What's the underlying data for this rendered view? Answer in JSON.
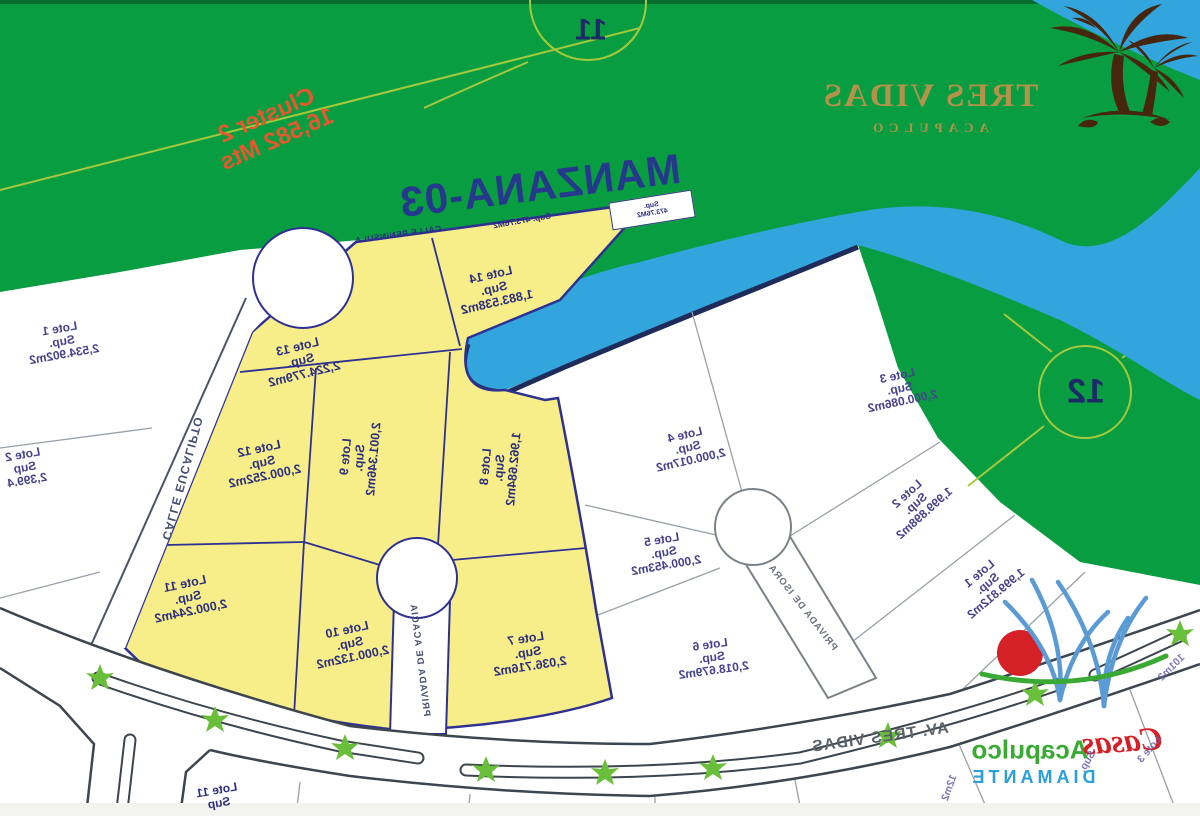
{
  "branding": {
    "resort_title": "TRES VIDAS",
    "resort_subtitle": "ACAPULCO",
    "footer_brand_script": "Casas",
    "footer_brand_name": "Acapulco",
    "footer_brand_sub": "DIAMANTE"
  },
  "map": {
    "title": "MANZANA-03",
    "cluster_note_line1": "Cluster 2",
    "cluster_note_line2": "16,582 Mts",
    "hole_marker_11": "11",
    "hole_marker_12": "12",
    "band_sup_label": "Sup. 473.76M2",
    "infobox_line1": "Sup.",
    "infobox_line2": "473.76M2"
  },
  "streets": {
    "eucalipto": "CALLE EUCALIPTO",
    "acacia": "PRIVADA DE ACACIA",
    "isora": "PRIVADA DE ISORA",
    "avenida": "AV. TRES VIDAS",
    "peninsula": "CALLE PENINSULA"
  },
  "lots_yellow": [
    {
      "name": "Lote 7",
      "sup": "Sup.",
      "area": "2,036.716m2"
    },
    {
      "name": "Lote 8",
      "sup": "Sup.",
      "area": "1,962.684m2"
    },
    {
      "name": "Lote 9",
      "sup": "Sup.",
      "area": "2,001.346m2"
    },
    {
      "name": "Lote 10",
      "sup": "Sup.",
      "area": "2,000.132m2"
    },
    {
      "name": "Lote 11",
      "sup": "Sup.",
      "area": "2,000.244m2"
    },
    {
      "name": "Lote 12",
      "sup": "Sup.",
      "area": "2,000.252m2"
    },
    {
      "name": "Lote 13",
      "sup": "Sup.",
      "area": "2,224.779m2"
    },
    {
      "name": "Lote 14",
      "sup": "Sup.",
      "area": "1,883.538m2"
    }
  ],
  "lots_white": [
    {
      "name": "Lote 1",
      "sup": "Sup.",
      "area": "1,999.812m2"
    },
    {
      "name": "Lote 2",
      "sup": "Sup.",
      "area": "1,999.898m2"
    },
    {
      "name": "Lote 3",
      "sup": "Sup.",
      "area": "2,000.086m2"
    },
    {
      "name": "Lote 4",
      "sup": "Sup.",
      "area": "2,000.017m2"
    },
    {
      "name": "Lote 5",
      "sup": "Sup.",
      "area": "2,000.453m2"
    },
    {
      "name": "Lote 6",
      "sup": "Sup.",
      "area": "2,018.679m2"
    }
  ],
  "lots_edge": [
    {
      "name": "Lote 1",
      "sup": "Sup.",
      "area": "2,534.902m2"
    },
    {
      "name": "Lote 2",
      "sup": "Sup",
      "area": "2,399.4"
    },
    {
      "name": "Lote 11",
      "sup": "Sup",
      "area": ""
    }
  ],
  "fragments": [
    "Lote 3",
    "Sup.",
    "101m2",
    "12m2"
  ],
  "colors": {
    "golf_green": "#089d41",
    "water_blue": "#31a5dc",
    "lot_yellow": "#f7ee8a",
    "outline_navy": "#2e3192",
    "logo_gold": "#b3924a",
    "cluster_orange": "#e4592e",
    "brand_red": "#d62027",
    "brand_blue": "#5b9bd5",
    "brand_green": "#3aaa35",
    "tree_green": "#6abf3a",
    "cartpath_green": "#a5c93c"
  }
}
